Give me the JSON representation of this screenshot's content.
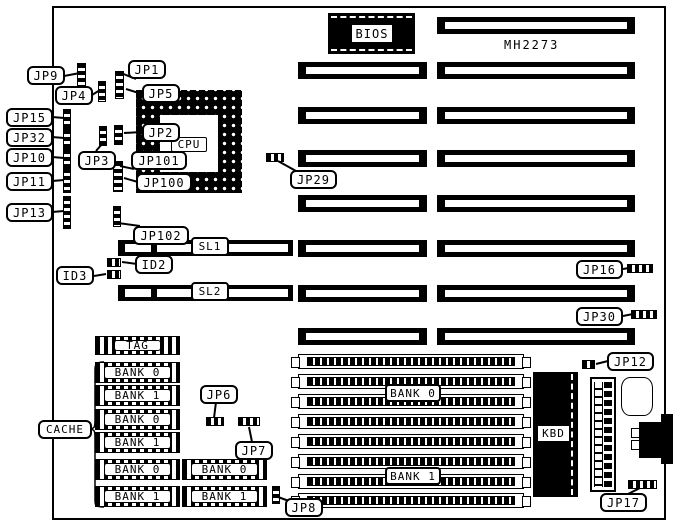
{
  "board": {
    "model": "MH2273",
    "chips": {
      "bios": "BIOS",
      "cpu": "CPU",
      "kbd": "KBD"
    },
    "slots": {
      "sl1": "SL1",
      "sl2": "SL2"
    },
    "cache": {
      "label": "CACHE",
      "tag": "TAG",
      "bank0": "BANK 0",
      "bank1": "BANK 1"
    },
    "memory": {
      "bank0": "BANK 0",
      "bank1": "BANK 1"
    },
    "jumpers": {
      "jp1": "JP1",
      "jp2": "JP2",
      "jp3": "JP3",
      "jp4": "JP4",
      "jp5": "JP5",
      "jp6": "JP6",
      "jp7": "JP7",
      "jp8": "JP8",
      "jp9": "JP9",
      "jp10": "JP10",
      "jp11": "JP11",
      "jp12": "JP12",
      "jp13": "JP13",
      "jp15": "JP15",
      "jp16": "JP16",
      "jp17": "JP17",
      "jp29": "JP29",
      "jp30": "JP30",
      "jp32": "JP32",
      "jp100": "JP100",
      "jp101": "JP101",
      "jp102": "JP102",
      "id2": "ID2",
      "id3": "ID3"
    }
  }
}
